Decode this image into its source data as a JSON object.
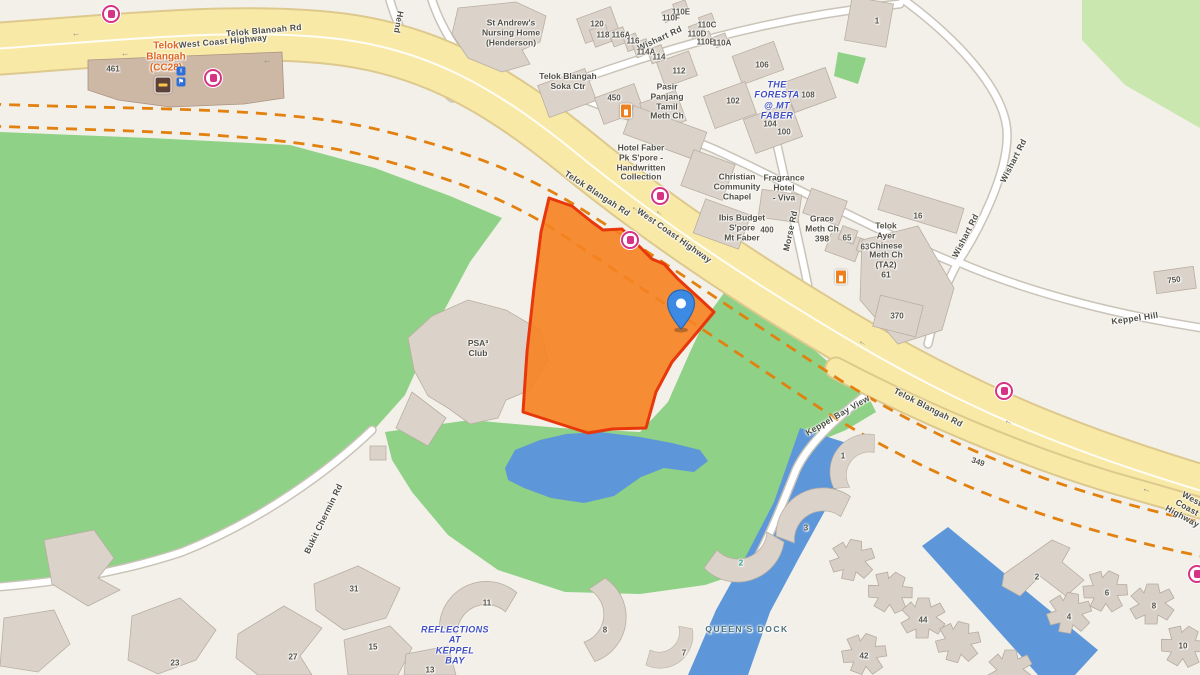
{
  "map": {
    "colors": {
      "parcel_fill": "#f68220",
      "parcel_border": "#e8380b",
      "highway_yellow": "#f8e9a6",
      "railway_orange": "#e2810f",
      "park_green": "#8fd186",
      "light_green": "#cbe7b0",
      "water_blue": "#5e97d9",
      "pin_blue": "#3d8ae4",
      "bus_stop_pink": "#d63384",
      "estate_label_blue": "#3f4ec4",
      "station_label_orange": "#e0671d"
    },
    "pin": {
      "x": 681,
      "y": 330
    },
    "icons": [
      {
        "type": "bus",
        "x": 111,
        "y": 14
      },
      {
        "type": "bus",
        "x": 213,
        "y": 78
      },
      {
        "type": "bus",
        "x": 630,
        "y": 240
      },
      {
        "type": "bus",
        "x": 660,
        "y": 196
      },
      {
        "type": "bus",
        "x": 1004,
        "y": 391
      },
      {
        "type": "bus",
        "x": 1197,
        "y": 574
      },
      {
        "type": "fuel",
        "x": 626,
        "y": 111
      },
      {
        "type": "fuel",
        "x": 841,
        "y": 277
      },
      {
        "type": "mrt",
        "x": 163,
        "y": 85
      },
      {
        "type": "info",
        "x": 181,
        "y": 71,
        "glyph": "i"
      },
      {
        "type": "info",
        "x": 181,
        "y": 82,
        "glyph": "⚑"
      }
    ],
    "labels": [
      {
        "id": "road-telok-blanoah-rd",
        "text": "Telok Blanoah Rd",
        "x": 264,
        "y": 31,
        "rot": -5,
        "cls": "road"
      },
      {
        "id": "road-west-coast-highway-top",
        "text": "West Coast Highway",
        "x": 223,
        "y": 42,
        "rot": -5,
        "cls": "road"
      },
      {
        "id": "station-telok-blangah",
        "text": "Telok\nBlangah\n(CC28)",
        "x": 166,
        "y": 57,
        "rot": 0,
        "cls": "station"
      },
      {
        "id": "num-461",
        "text": "461",
        "x": 113,
        "y": 69,
        "rot": 0,
        "cls": "num"
      },
      {
        "id": "poi-st-andrews",
        "text": "St Andrew's\nNursing Home\n(Henderson)",
        "x": 511,
        "y": 33,
        "rot": 0,
        "cls": "poi"
      },
      {
        "id": "road-henderson",
        "text": "Hend",
        "x": 398,
        "y": 22,
        "rot": 100,
        "cls": "road"
      },
      {
        "id": "road-wishart-row",
        "text": "Wishart Rd",
        "x": 660,
        "y": 39,
        "rot": -25,
        "cls": "road"
      },
      {
        "id": "num-120",
        "text": "120",
        "x": 597,
        "y": 24,
        "rot": 0,
        "cls": "num"
      },
      {
        "id": "num-118",
        "text": "118",
        "x": 603,
        "y": 35,
        "rot": 0,
        "cls": "num"
      },
      {
        "id": "num-116A",
        "text": "116A",
        "x": 621,
        "y": 35,
        "rot": 0,
        "cls": "num"
      },
      {
        "id": "num-116",
        "text": "116",
        "x": 633,
        "y": 41,
        "rot": 0,
        "cls": "num"
      },
      {
        "id": "num-114A",
        "text": "114A",
        "x": 646,
        "y": 52,
        "rot": 0,
        "cls": "num"
      },
      {
        "id": "num-114",
        "text": "114",
        "x": 659,
        "y": 57,
        "rot": 0,
        "cls": "num"
      },
      {
        "id": "num-112",
        "text": "112",
        "x": 679,
        "y": 71,
        "rot": 0,
        "cls": "num"
      },
      {
        "id": "num-110E",
        "text": "110E",
        "x": 681,
        "y": 12,
        "rot": 0,
        "cls": "num"
      },
      {
        "id": "num-110F",
        "text": "110F",
        "x": 671,
        "y": 18,
        "rot": 0,
        "cls": "num"
      },
      {
        "id": "num-110C",
        "text": "110C",
        "x": 707,
        "y": 25,
        "rot": 0,
        "cls": "num"
      },
      {
        "id": "num-110D",
        "text": "110D",
        "x": 697,
        "y": 34,
        "rot": 0,
        "cls": "num"
      },
      {
        "id": "num-110B",
        "text": "110B",
        "x": 706,
        "y": 42,
        "rot": 0,
        "cls": "num"
      },
      {
        "id": "num-110A",
        "text": "110A",
        "x": 722,
        "y": 43,
        "rot": 0,
        "cls": "num"
      },
      {
        "id": "num-106",
        "text": "106",
        "x": 762,
        "y": 65,
        "rot": 0,
        "cls": "num"
      },
      {
        "id": "num-108",
        "text": "108",
        "x": 808,
        "y": 95,
        "rot": 0,
        "cls": "num"
      },
      {
        "id": "num-102",
        "text": "102",
        "x": 733,
        "y": 101,
        "rot": 0,
        "cls": "num"
      },
      {
        "id": "num-104",
        "text": "104",
        "x": 770,
        "y": 124,
        "rot": 0,
        "cls": "num"
      },
      {
        "id": "num-100",
        "text": "100",
        "x": 784,
        "y": 132,
        "rot": 0,
        "cls": "num"
      },
      {
        "id": "num-1-top",
        "text": "1",
        "x": 877,
        "y": 21,
        "rot": 0,
        "cls": "num"
      },
      {
        "id": "poi-soka",
        "text": "Telok Blangah\nSoka Ctr",
        "x": 568,
        "y": 82,
        "rot": 0,
        "cls": "poi"
      },
      {
        "id": "num-450",
        "text": "450",
        "x": 614,
        "y": 98,
        "rot": 0,
        "cls": "num"
      },
      {
        "id": "poi-pasir-panjang",
        "text": "Pasir\nPanjang\nTamil\nMeth Ch",
        "x": 667,
        "y": 102,
        "rot": 0,
        "cls": "poi"
      },
      {
        "id": "estate-foresta",
        "text": "THE\nFORESTA\n@ MT\nFABER",
        "x": 777,
        "y": 100,
        "rot": 0,
        "cls": "estate"
      },
      {
        "id": "poi-hotel-faber",
        "text": "Hotel Faber\nPk S'pore -\nHandwritten\nCollection",
        "x": 641,
        "y": 163,
        "rot": 0,
        "cls": "poi"
      },
      {
        "id": "poi-christian-chapel",
        "text": "Christian\nCommunity\nChapel",
        "x": 737,
        "y": 187,
        "rot": 0,
        "cls": "poi"
      },
      {
        "id": "poi-fragrance-hotel",
        "text": "Fragrance\nHotel\n- Viva",
        "x": 784,
        "y": 188,
        "rot": 0,
        "cls": "poi"
      },
      {
        "id": "poi-ibis-budget",
        "text": "Ibis Budget\nS'pore\nMt Faber",
        "x": 742,
        "y": 228,
        "rot": 0,
        "cls": "poi"
      },
      {
        "id": "num-400",
        "text": "400",
        "x": 767,
        "y": 230,
        "rot": 0,
        "cls": "num"
      },
      {
        "id": "road-morse-rd",
        "text": "Morse Rd",
        "x": 791,
        "y": 231,
        "rot": -78,
        "cls": "road"
      },
      {
        "id": "poi-grace-meth",
        "text": "Grace\nMeth Ch\n398",
        "x": 822,
        "y": 229,
        "rot": 0,
        "cls": "poi"
      },
      {
        "id": "num-65",
        "text": "65",
        "x": 847,
        "y": 238,
        "rot": 0,
        "cls": "num"
      },
      {
        "id": "num-63",
        "text": "63",
        "x": 865,
        "y": 247,
        "rot": 0,
        "cls": "num"
      },
      {
        "id": "poi-telok-ayer",
        "text": "Telok\nAyer\nChinese\nMeth Ch\n(TA2)\n61",
        "x": 886,
        "y": 251,
        "rot": 0,
        "cls": "poi"
      },
      {
        "id": "num-16",
        "text": "16",
        "x": 918,
        "y": 216,
        "rot": 0,
        "cls": "num"
      },
      {
        "id": "num-370",
        "text": "370",
        "x": 897,
        "y": 316,
        "rot": 0,
        "cls": "num"
      },
      {
        "id": "num-750",
        "text": "750",
        "x": 1174,
        "y": 280,
        "rot": -8,
        "cls": "num"
      },
      {
        "id": "road-wishart-upper",
        "text": "Wishart Rd",
        "x": 1014,
        "y": 161,
        "rot": -63,
        "cls": "road"
      },
      {
        "id": "road-wishart-mid",
        "text": "Wishart Rd",
        "x": 966,
        "y": 236,
        "rot": -63,
        "cls": "road"
      },
      {
        "id": "road-keppel-hill",
        "text": "Keppel Hill",
        "x": 1135,
        "y": 319,
        "rot": -8,
        "cls": "road"
      },
      {
        "id": "road-telok-blangah-rd-mid",
        "text": "Telok Blangah Rd",
        "x": 597,
        "y": 194,
        "rot": 33,
        "cls": "road"
      },
      {
        "id": "road-west-coast-highway-mid",
        "text": "West Coast Highway",
        "x": 674,
        "y": 236,
        "rot": 35,
        "cls": "road"
      },
      {
        "id": "poi-psa-club",
        "text": "PSA³\nClub",
        "x": 478,
        "y": 349,
        "rot": 0,
        "cls": "poi"
      },
      {
        "id": "road-bukit-chermin",
        "text": "Bukit Chermin Rd",
        "x": 324,
        "y": 519,
        "rot": -64,
        "cls": "road"
      },
      {
        "id": "road-keppel-bay-view",
        "text": "Keppel Bay View",
        "x": 838,
        "y": 416,
        "rot": -30,
        "cls": "road"
      },
      {
        "id": "road-telok-blangah-rd-se",
        "text": "Telok Blangah Rd",
        "x": 928,
        "y": 408,
        "rot": 27,
        "cls": "road"
      },
      {
        "id": "num-349",
        "text": "349",
        "x": 978,
        "y": 462,
        "rot": 20,
        "cls": "num"
      },
      {
        "id": "num-1-kbv",
        "text": "1",
        "x": 843,
        "y": 456,
        "rot": 0,
        "cls": "num"
      },
      {
        "id": "road-west-coast-highway-right",
        "text": "West Coast Highway",
        "x": 1187,
        "y": 508,
        "rot": 29,
        "cls": "road"
      },
      {
        "id": "estate-reflections",
        "text": "REFLECTIONS\nAT\nKEPPEL\nBAY",
        "x": 455,
        "y": 645,
        "rot": 0,
        "cls": "estate"
      },
      {
        "id": "poi-queens-dock",
        "text": "QUEEN'S DOCK",
        "x": 747,
        "y": 630,
        "rot": 0,
        "cls": "dock"
      },
      {
        "id": "num-31",
        "text": "31",
        "x": 354,
        "y": 589,
        "rot": 0,
        "cls": "num"
      },
      {
        "id": "num-27",
        "text": "27",
        "x": 293,
        "y": 657,
        "rot": 0,
        "cls": "num"
      },
      {
        "id": "num-23",
        "text": "23",
        "x": 175,
        "y": 663,
        "rot": 0,
        "cls": "num"
      },
      {
        "id": "num-15",
        "text": "15",
        "x": 373,
        "y": 647,
        "rot": 0,
        "cls": "num"
      },
      {
        "id": "num-13",
        "text": "13",
        "x": 430,
        "y": 670,
        "rot": 0,
        "cls": "num"
      },
      {
        "id": "num-11",
        "text": "11",
        "x": 487,
        "y": 603,
        "rot": 0,
        "cls": "num"
      },
      {
        "id": "num-8-reflections",
        "text": "8",
        "x": 605,
        "y": 630,
        "rot": 0,
        "cls": "num"
      },
      {
        "id": "num-7",
        "text": "7",
        "x": 684,
        "y": 653,
        "rot": 0,
        "cls": "num"
      },
      {
        "id": "num-3",
        "text": "3",
        "x": 806,
        "y": 528,
        "rot": 0,
        "cls": "num"
      },
      {
        "id": "num-2-teal",
        "text": "2",
        "x": 741,
        "y": 563,
        "rot": 0,
        "cls": "num-teal"
      },
      {
        "id": "num-42",
        "text": "42",
        "x": 864,
        "y": 656,
        "rot": 0,
        "cls": "num"
      },
      {
        "id": "num-44",
        "text": "44",
        "x": 923,
        "y": 620,
        "rot": 0,
        "cls": "num"
      },
      {
        "id": "num-2-caribbean",
        "text": "2",
        "x": 1037,
        "y": 577,
        "rot": 0,
        "cls": "num"
      },
      {
        "id": "num-4",
        "text": "4",
        "x": 1069,
        "y": 617,
        "rot": 0,
        "cls": "num"
      },
      {
        "id": "num-6",
        "text": "6",
        "x": 1107,
        "y": 593,
        "rot": 0,
        "cls": "num"
      },
      {
        "id": "num-8-caribbean",
        "text": "8",
        "x": 1154,
        "y": 606,
        "rot": 0,
        "cls": "num"
      },
      {
        "id": "num-10",
        "text": "10",
        "x": 1183,
        "y": 646,
        "rot": 0,
        "cls": "num"
      },
      {
        "id": "arrow-1",
        "text": "←",
        "x": 76,
        "y": 33,
        "rot": -6,
        "cls": "arrow"
      },
      {
        "id": "arrow-2",
        "text": "←",
        "x": 125,
        "y": 53,
        "rot": -6,
        "cls": "arrow"
      },
      {
        "id": "arrow-3",
        "text": "←",
        "x": 267,
        "y": 60,
        "rot": -6,
        "cls": "arrow"
      },
      {
        "id": "arrow-4",
        "text": "←",
        "x": 636,
        "y": 208,
        "rot": 33,
        "cls": "arrow"
      },
      {
        "id": "arrow-5",
        "text": "←",
        "x": 660,
        "y": 212,
        "rot": 33,
        "cls": "arrow"
      },
      {
        "id": "arrow-6",
        "text": "←",
        "x": 863,
        "y": 342,
        "rot": 28,
        "cls": "arrow"
      },
      {
        "id": "arrow-7",
        "text": "←",
        "x": 1009,
        "y": 421,
        "rot": 24,
        "cls": "arrow"
      },
      {
        "id": "arrow-8",
        "text": "←",
        "x": 1147,
        "y": 489,
        "rot": 20,
        "cls": "arrow"
      }
    ]
  }
}
